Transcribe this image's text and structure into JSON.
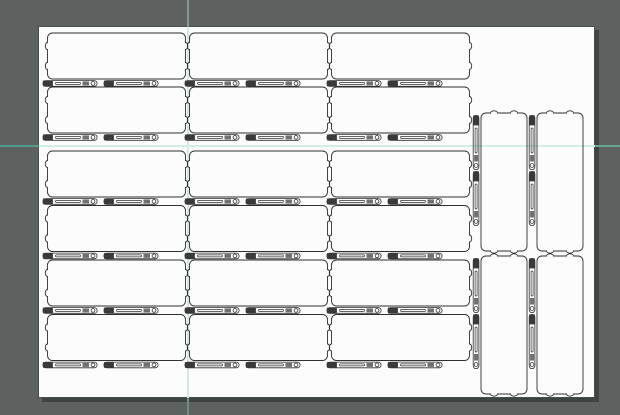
{
  "window": {
    "width": 620,
    "height": 415,
    "background": "#5d615f"
  },
  "artboard": {
    "x": 38,
    "y": 26,
    "width": 557,
    "height": 372,
    "fill": "#fcfcfc",
    "border_color": "#4a4e4c",
    "shadow_color": "#3f4341",
    "shadow_dx": 4,
    "shadow_dy": 4
  },
  "guides": {
    "vertical": {
      "x": 186.8,
      "width": 2.4,
      "above_color": "#7f9b8e",
      "canvas_color": "#d0ebe4",
      "below_color": "#6d9082"
    },
    "horizontal": {
      "y": 145.2,
      "height": 2.2,
      "left_color": "#4f9c8c",
      "canvas_color": "#d5ede7",
      "right_color": "#69a795"
    }
  },
  "pieces": {
    "outline_color": "#303030",
    "outline_width": 0.9,
    "pin_dark_color": "#3a3a3a",
    "pin_mid_color": "#707070",
    "pin_ring_fill": "#ffffff",
    "panel": {
      "width": 138,
      "height": 46,
      "corner_radius": 5,
      "notch_offsets": [
        13,
        33
      ]
    },
    "pin": {
      "length": 55,
      "width": 6.5
    },
    "horizontal_units": {
      "col_x": [
        47.5,
        189.5,
        331.5
      ],
      "row_y": [
        33,
        87,
        151,
        205.5,
        260,
        314.5
      ],
      "pin_dx": [
        -5,
        56
      ],
      "pin_dy": 47.2
    },
    "vertical_units": {
      "positions": [
        {
          "x": 527,
          "y": 113
        },
        {
          "x": 583,
          "y": 113
        },
        {
          "x": 527,
          "y": 256
        },
        {
          "x": 583,
          "y": 256
        }
      ],
      "pin_dy": [
        2,
        58
      ]
    },
    "counts": {
      "horizontal_panels": 18,
      "vertical_panels": 4,
      "pins_per_panel": 2
    }
  }
}
